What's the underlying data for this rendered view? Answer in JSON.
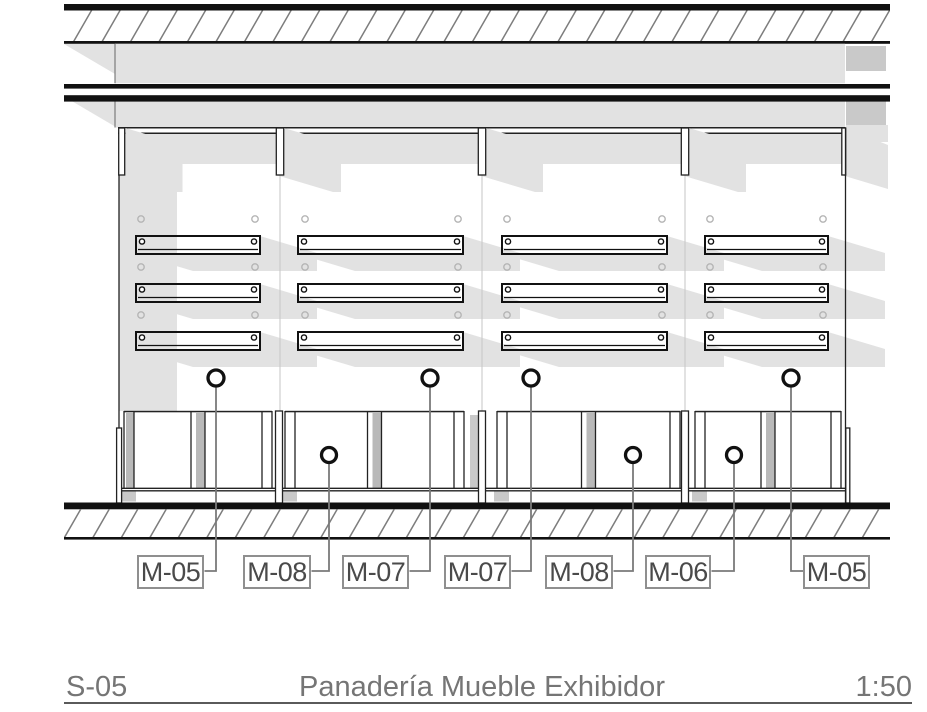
{
  "drawing": {
    "sheet_id": "S-05",
    "title": "Panadería Mueble Exhibidor",
    "scale": "1:50",
    "callouts": [
      {
        "label": "M-05"
      },
      {
        "label": "M-08"
      },
      {
        "label": "M-07"
      },
      {
        "label": "M-07"
      },
      {
        "label": "M-08"
      },
      {
        "label": "M-06"
      },
      {
        "label": "M-05"
      }
    ],
    "colors": {
      "shadow": "#e2e2e2",
      "shadow_dark": "#c9c9c9",
      "panel_shadow": "#b9b9b9",
      "line": "#111111",
      "leader": "#7a7a7a",
      "label_border": "#8f8f8f",
      "label_text": "#4a4a4a",
      "title_text": "#757575"
    }
  }
}
